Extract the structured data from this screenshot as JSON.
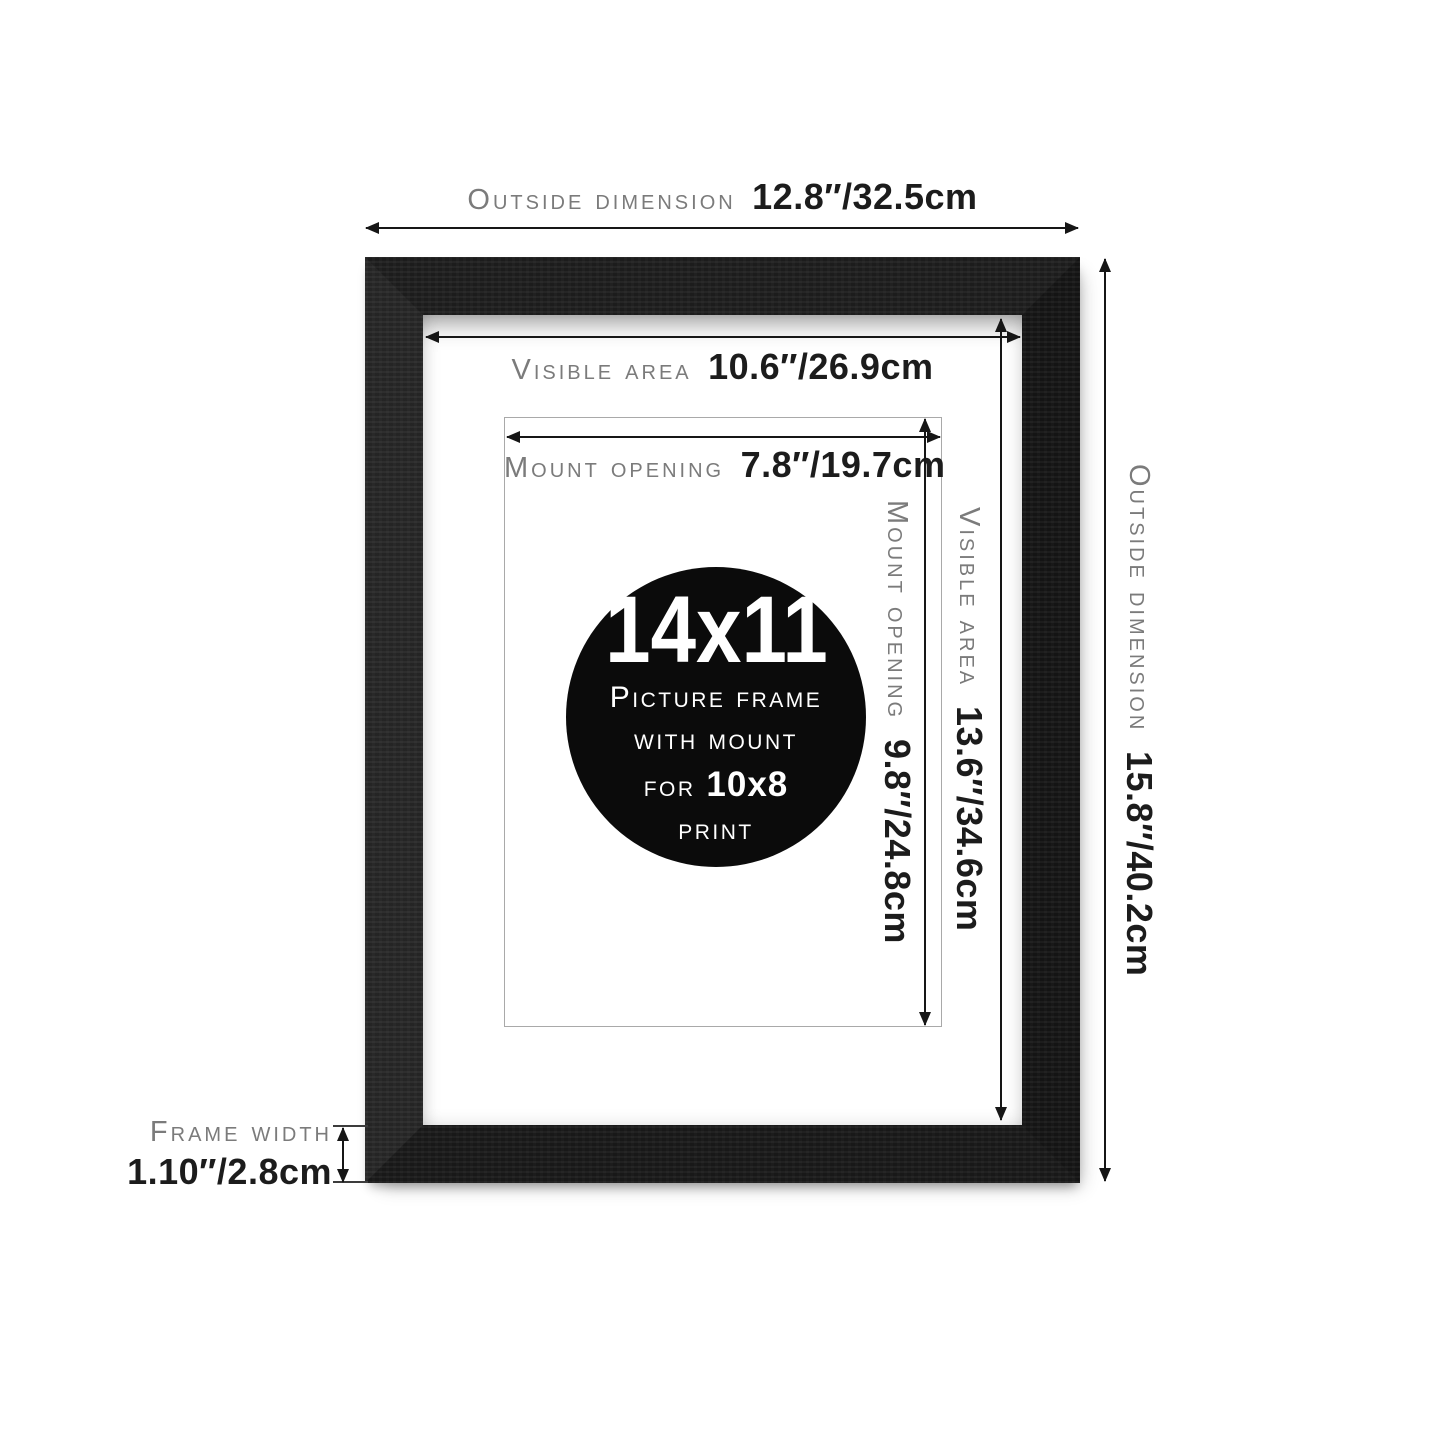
{
  "badge": {
    "size": "14x11",
    "line1": "Picture frame",
    "line2": "with mount",
    "for_label": "for",
    "for_value": "10x8",
    "line4": "print"
  },
  "callouts": {
    "outside_width": {
      "label": "Outside dimension",
      "value": "12.8″/32.5cm"
    },
    "outside_height": {
      "label": "Outside dimension",
      "value": "15.8″/40.2cm"
    },
    "visible_width": {
      "label": "Visible area",
      "value": "10.6″/26.9cm"
    },
    "visible_height": {
      "label": "Visible area",
      "value": "13.6″/34.6cm"
    },
    "mount_width": {
      "label": "Mount opening",
      "value": "7.8″/19.7cm"
    },
    "mount_height": {
      "label": "Mount opening",
      "value": "9.8″/24.8cm"
    },
    "frame_width": {
      "label": "Frame width",
      "value": "1.10″/2.8cm"
    }
  },
  "colors": {
    "background": "#ffffff",
    "frame": "#1b1b1b",
    "label": "#7b7b7b",
    "value": "#1c1c1c",
    "arrow": "#161616",
    "badge_bg": "#0b0b0b",
    "outline": "#a9a9a9"
  }
}
